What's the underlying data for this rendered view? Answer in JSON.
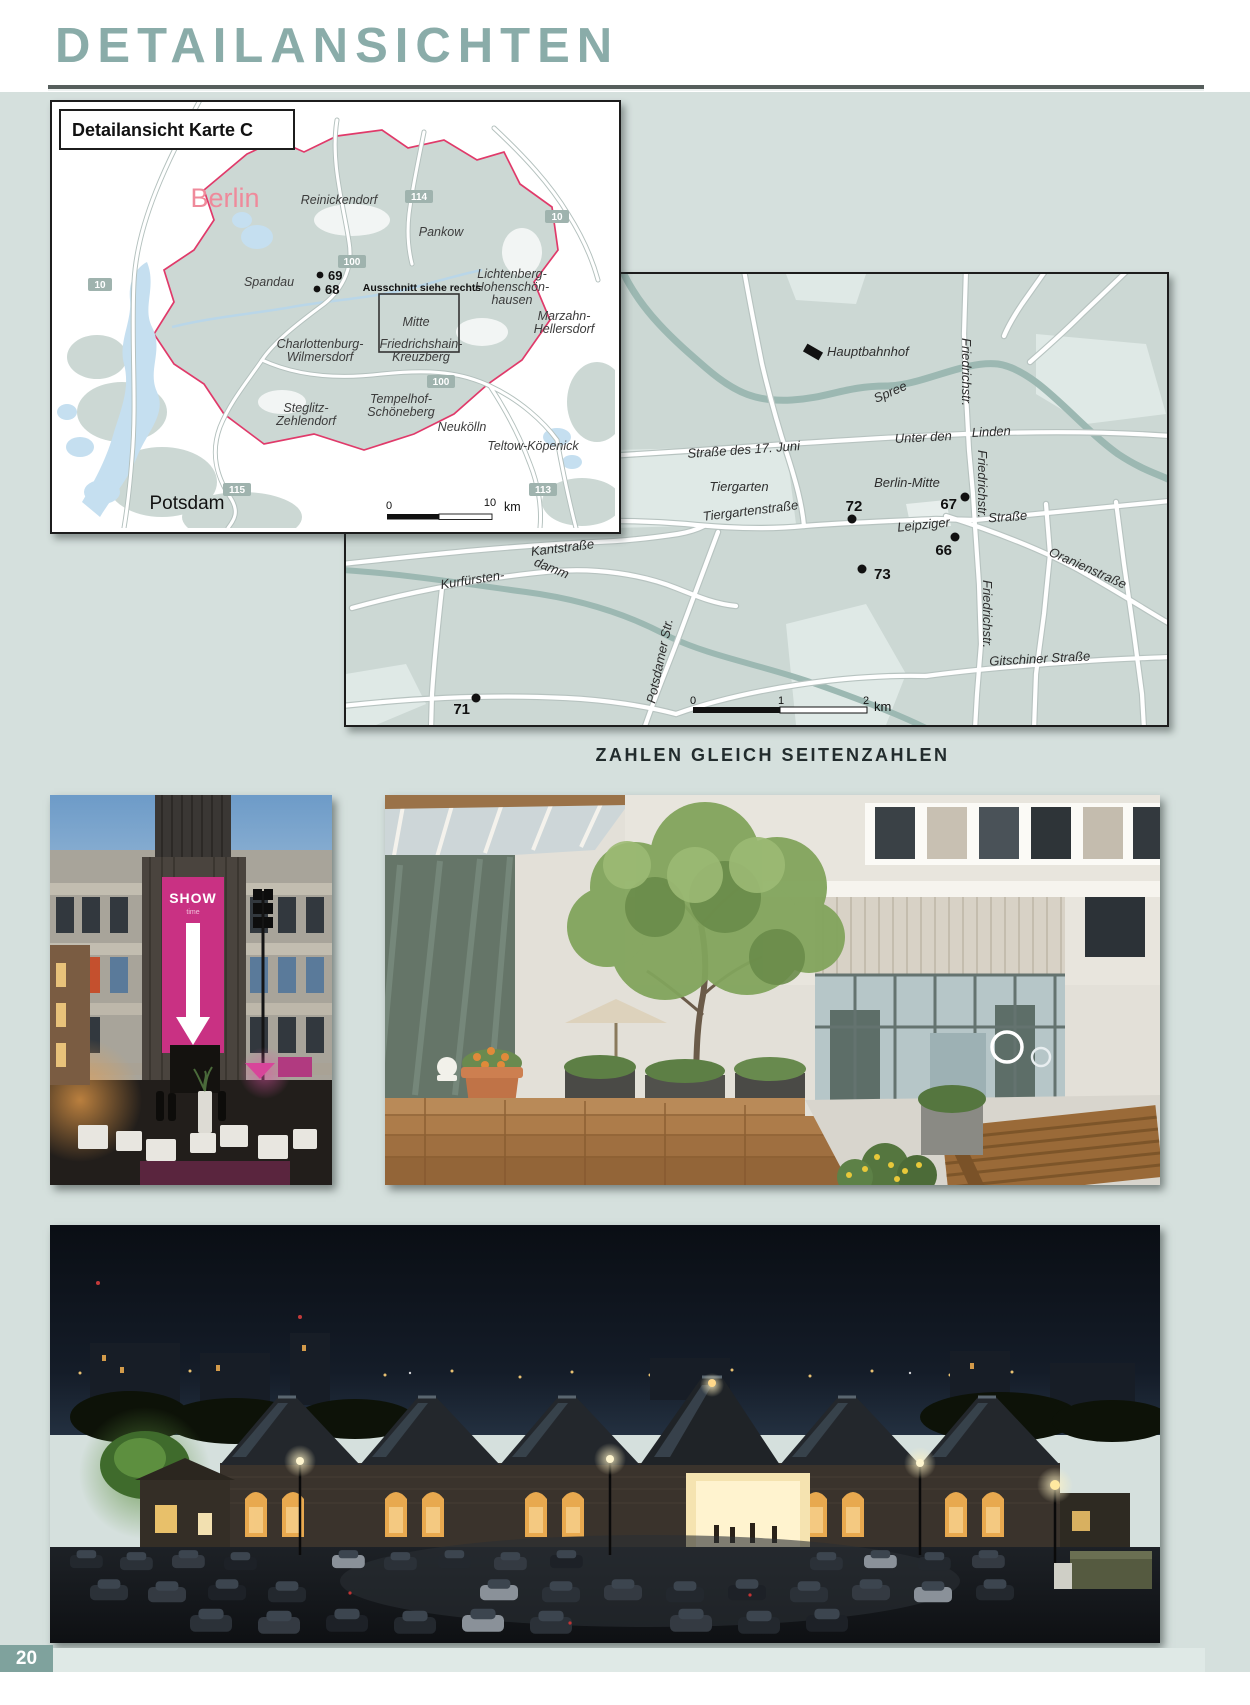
{
  "page": {
    "title": "DETAILANSICHTEN",
    "caption": "ZAHLEN GLEICH SEITENZAHLEN",
    "page_number": "20",
    "accent_color": "#8aaca9",
    "background_color": "#d5e0dd"
  },
  "map_overview": {
    "header": "Detailansicht Karte C",
    "city": "Berlin",
    "note": "Ausschnitt siehe rechts",
    "districts": {
      "reinickendorf": "Reinickendorf",
      "pankow": "Pankow",
      "lichtenberg1": "Lichtenberg-",
      "lichtenberg2": "Hohenschön-",
      "lichtenberg3": "hausen",
      "spandau": "Spandau",
      "marzahn1": "Marzahn-",
      "marzahn2": "Hellersdorf",
      "mitte": "Mitte",
      "charlottenburg1": "Charlottenburg-",
      "charlottenburg2": "Wilmersdorf",
      "friedrichshain1": "Friedrichshain-",
      "friedrichshain2": "Kreuzberg",
      "tempelhof1": "Tempelhof-",
      "tempelhof2": "Schöneberg",
      "steglitz1": "Steglitz-",
      "steglitz2": "Zehlendorf",
      "neukoelln": "Neukölln",
      "teltow": "Teltow-Köpenick",
      "potsdam": "Potsdam"
    },
    "road_badges": {
      "a10_west": "10",
      "a100_north": "100",
      "a114": "114",
      "a10_east": "10",
      "a100_south": "100",
      "a115": "115",
      "a113": "113"
    },
    "points": {
      "p69": "69",
      "p68": "68"
    },
    "scale": {
      "start": "0",
      "end": "10",
      "unit": "km"
    }
  },
  "map_detail": {
    "labels": {
      "hauptbahnhof": "Hauptbahnhof",
      "friedrichstr_north": "Friedrichstr.",
      "friedrichstr_mid": "Friedrichstr.",
      "friedrichstr_south": "Friedrichstr.",
      "spree": "Spree",
      "strasse_17_juni": "Straße des 17. Juni",
      "unter_den": "Unter den",
      "linden": "Linden",
      "tiergarten": "Tiergarten",
      "berlin_mitte": "Berlin-Mitte",
      "tiergartenstrasse": "Tiergartenstraße",
      "leipziger": "Leipziger",
      "leipziger_strasse": "Straße",
      "kantstrasse": "Kantstraße",
      "kurfuersten": "Kurfürsten-",
      "damm": "damm",
      "oranienstrasse": "Oranienstraße",
      "potsdamer_str": "Potsdamer Str.",
      "gitschiner": "Gitschiner Straße"
    },
    "points": {
      "p72": "72",
      "p67": "67",
      "p66": "66",
      "p73": "73",
      "p71": "71"
    },
    "scale": {
      "start": "0",
      "mid": "1",
      "end": "2",
      "unit": "km"
    }
  },
  "photos": {
    "show_banner": {
      "title": "SHOW",
      "subtitle": "time"
    }
  }
}
